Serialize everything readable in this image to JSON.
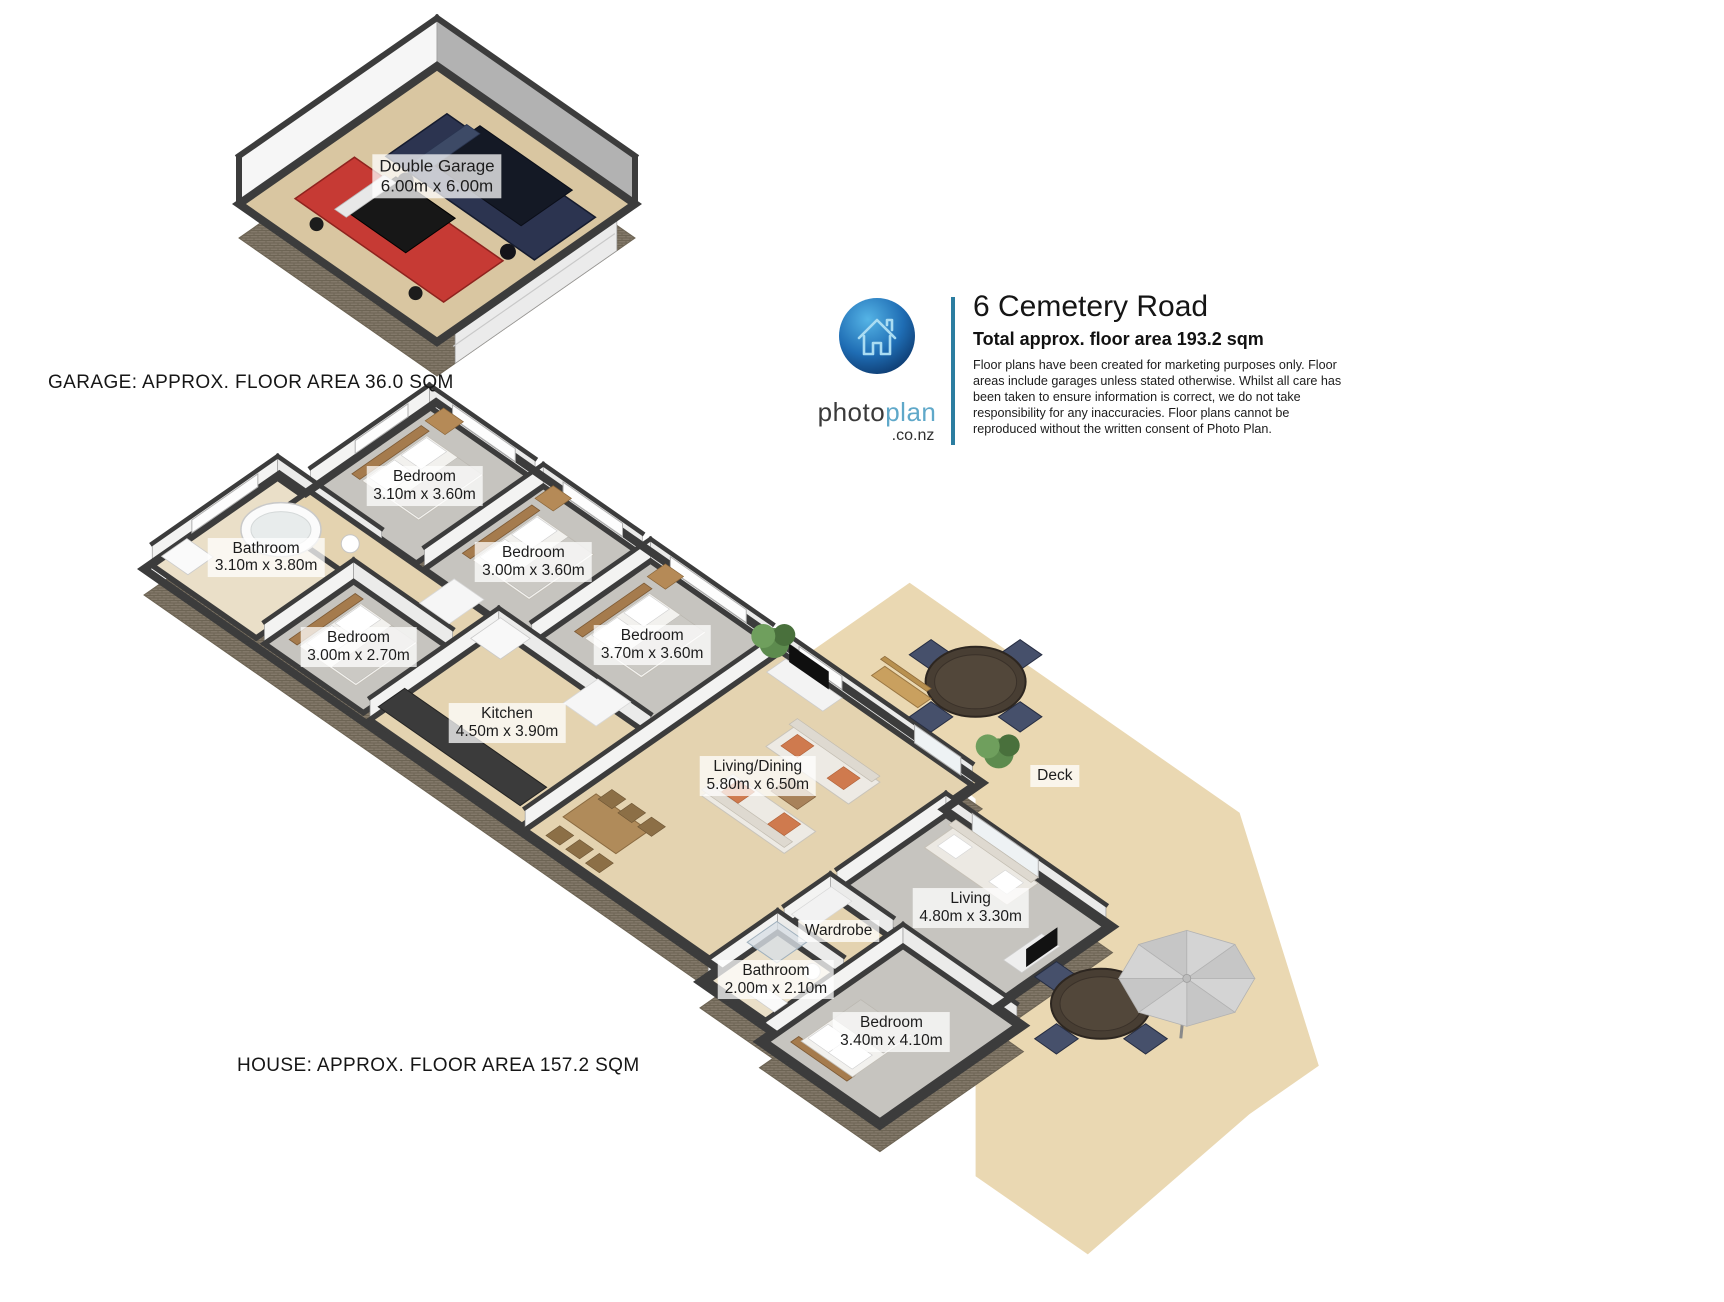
{
  "header": {
    "title": "6 Cemetery Road",
    "subtitle": "Total approx. floor area 193.2 sqm",
    "disclaimer": "Floor plans have been created for marketing purposes only. Floor areas include garages unless stated otherwise. Whilst all care has been taken to ensure information is correct, we do not take responsibility for any inaccuracies. Floor plans cannot be reproduced without the written consent of Photo Plan.",
    "brand": {
      "photo": "photo",
      "plan": "plan",
      "domain": ".co.nz",
      "icon": "house-icon"
    }
  },
  "captions": {
    "garage": "GARAGE: APPROX. FLOOR AREA 36.0 SQM",
    "house": "HOUSE: APPROX. FLOOR AREA 157.2 SQM"
  },
  "garage": {
    "label": {
      "name": "Double Garage",
      "dims": "6.00m x 6.00m"
    }
  },
  "house": {
    "rooms": {
      "bedroom1": {
        "name": "Bedroom",
        "dims": "3.10m x 3.60m"
      },
      "bedroom2": {
        "name": "Bedroom",
        "dims": "3.00m x 3.60m"
      },
      "bedroom3": {
        "name": "Bedroom",
        "dims": "3.70m x 3.60m"
      },
      "bathroom1": {
        "name": "Bathroom",
        "dims": "3.10m x 3.80m"
      },
      "bedroom4": {
        "name": "Bedroom",
        "dims": "3.00m x 2.70m"
      },
      "kitchen": {
        "name": "Kitchen",
        "dims": "4.50m x 3.90m"
      },
      "livingdining": {
        "name": "Living/Dining",
        "dims": "5.80m x 6.50m"
      },
      "deck": {
        "name": "Deck",
        "dims": ""
      },
      "living2": {
        "name": "Living",
        "dims": "4.80m x 3.30m"
      },
      "wardrobe": {
        "name": "Wardrobe",
        "dims": ""
      },
      "bathroom2": {
        "name": "Bathroom",
        "dims": "2.00m x 2.10m"
      },
      "bedroom5": {
        "name": "Bedroom",
        "dims": "3.40m x 4.10m"
      }
    }
  },
  "colors": {
    "accent": "#2b7da0",
    "brand_dark": "#3a3a3a",
    "brand_light": "#5fa8c9",
    "wall": "#3c3c3c",
    "wall_face_nw": "#f3f3f2",
    "wall_face_ne": "#ebebea",
    "carpet": "#c6c4bf",
    "floor_tan": "#e4d3b0",
    "floor_tile": "#eadfc8",
    "deck": "#ead8b2",
    "garage_floor": "#d9c6a1",
    "brick": "#83796a",
    "label_text": "#1d1d1d"
  }
}
